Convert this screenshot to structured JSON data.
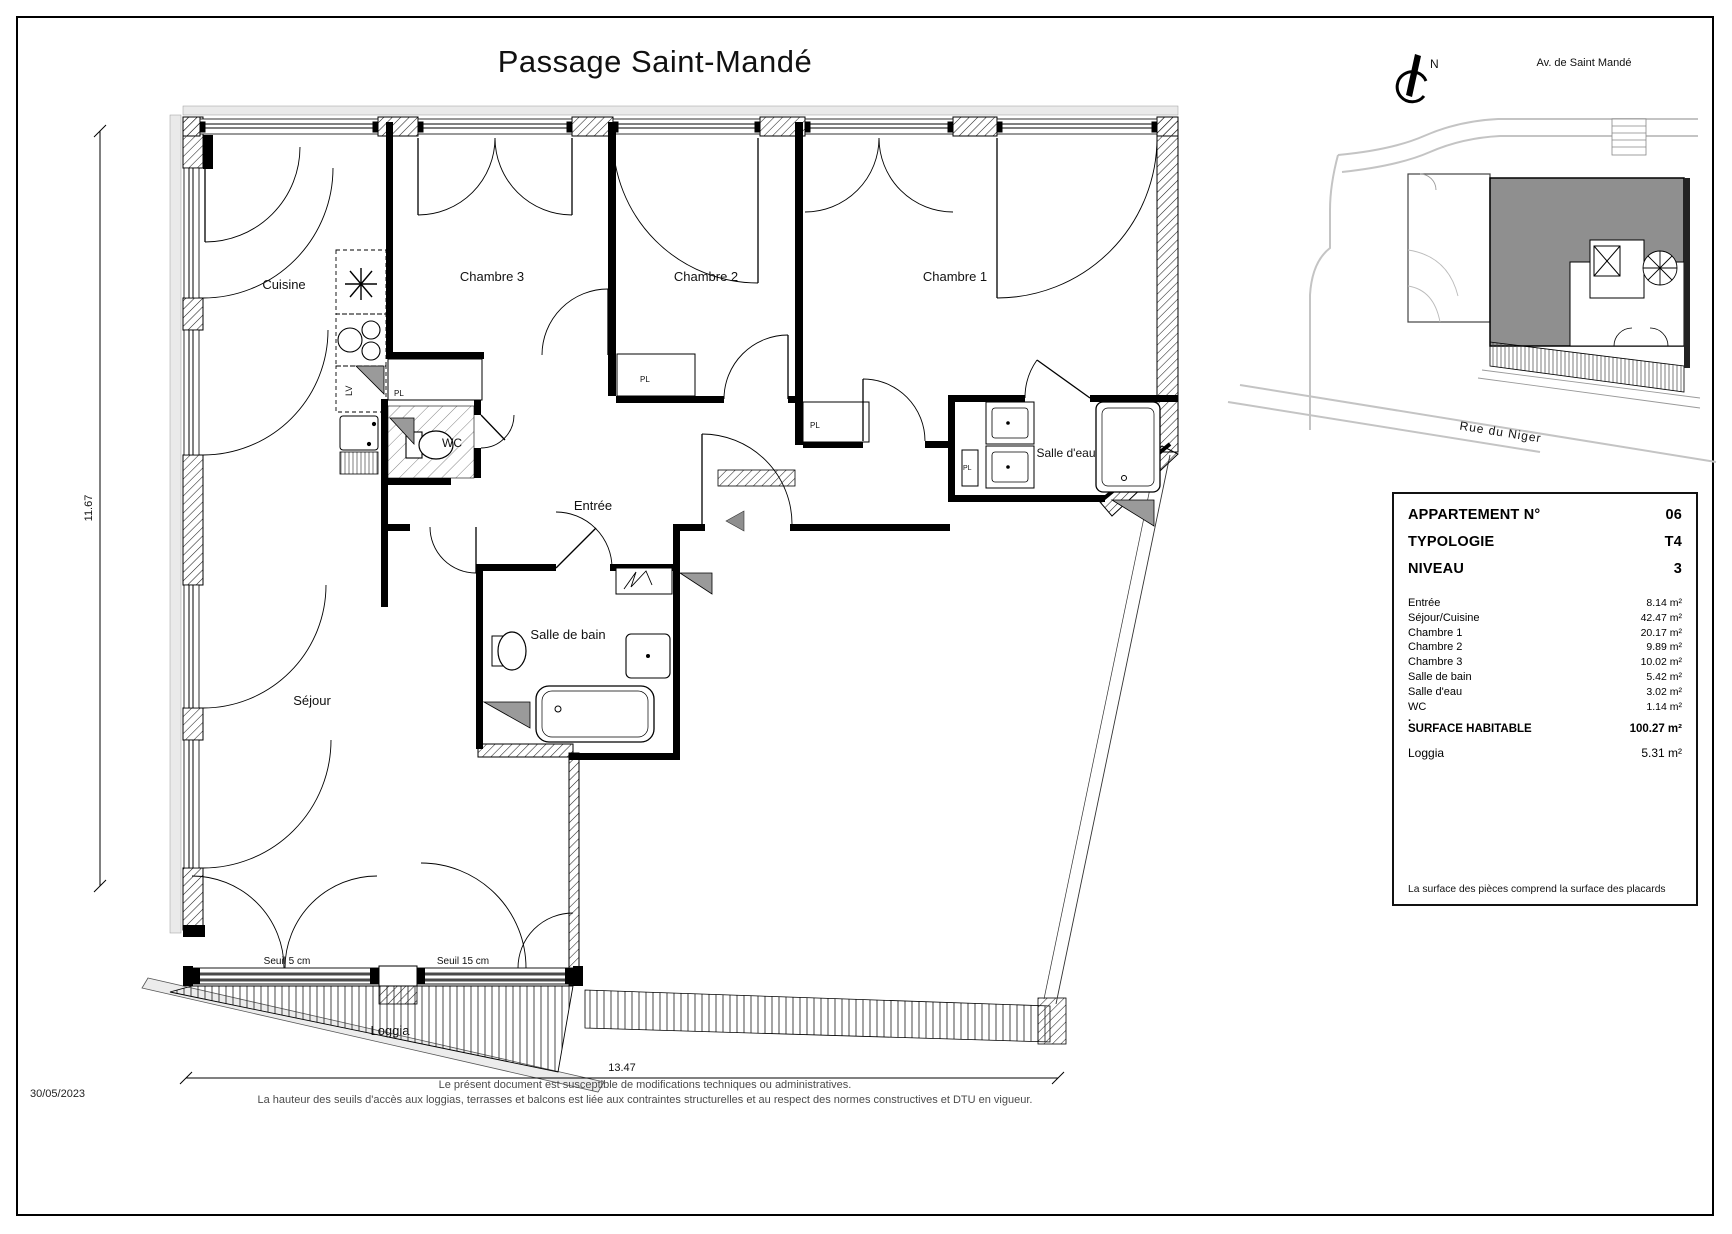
{
  "title": "Passage Saint-Mandé",
  "date": "30/05/2023",
  "dimensions": {
    "height_label": "11.67",
    "width_label": "13.47"
  },
  "rooms": {
    "cuisine": "Cuisine",
    "chambre3": "Chambre 3",
    "chambre2": "Chambre 2",
    "chambre1": "Chambre 1",
    "wc": "WC",
    "entree": "Entrée",
    "salle_deau": "Salle d'eau",
    "salle_de_bain": "Salle de bain",
    "sejour": "Séjour",
    "loggia": "Loggia"
  },
  "annotations": {
    "pl": "PL",
    "lv": "LV",
    "seuil_left": "Seuil 5 cm",
    "seuil_right": "Seuil 15 cm"
  },
  "map": {
    "north": "N",
    "street_top": "Av. de Saint Mandé",
    "street_bottom": "Rue du Niger"
  },
  "panel": {
    "fields": [
      {
        "label": "APPARTEMENT N°",
        "value": "06"
      },
      {
        "label": "TYPOLOGIE",
        "value": "T4"
      },
      {
        "label": "NIVEAU",
        "value": "3"
      }
    ],
    "areas": [
      {
        "label": "Entrée",
        "value": "8.14 m²"
      },
      {
        "label": "Séjour/Cuisine",
        "value": "42.47 m²"
      },
      {
        "label": "Chambre 1",
        "value": "20.17 m²"
      },
      {
        "label": "Chambre 2",
        "value": "9.89 m²"
      },
      {
        "label": "Chambre 3",
        "value": "10.02 m²"
      },
      {
        "label": "Salle de bain",
        "value": "5.42 m²"
      },
      {
        "label": "Salle d'eau",
        "value": "3.02 m²"
      },
      {
        "label": "WC",
        "value": "1.14 m²"
      }
    ],
    "separator": ".",
    "total": {
      "label": "SURFACE HABITABLE",
      "value": "100.27 m²"
    },
    "loggia_row": {
      "label": "Loggia",
      "value": "5.31 m²"
    },
    "note": "La surface des pièces comprend la surface des placards"
  },
  "footer": {
    "line1": "Le présent document est susceptible de modifications techniques ou administratives.",
    "line2": "La hauteur des seuils d'accès aux loggias, terrasses et balcons est liée aux contraintes structurelles et au respect des normes constructives et DTU en vigueur."
  }
}
